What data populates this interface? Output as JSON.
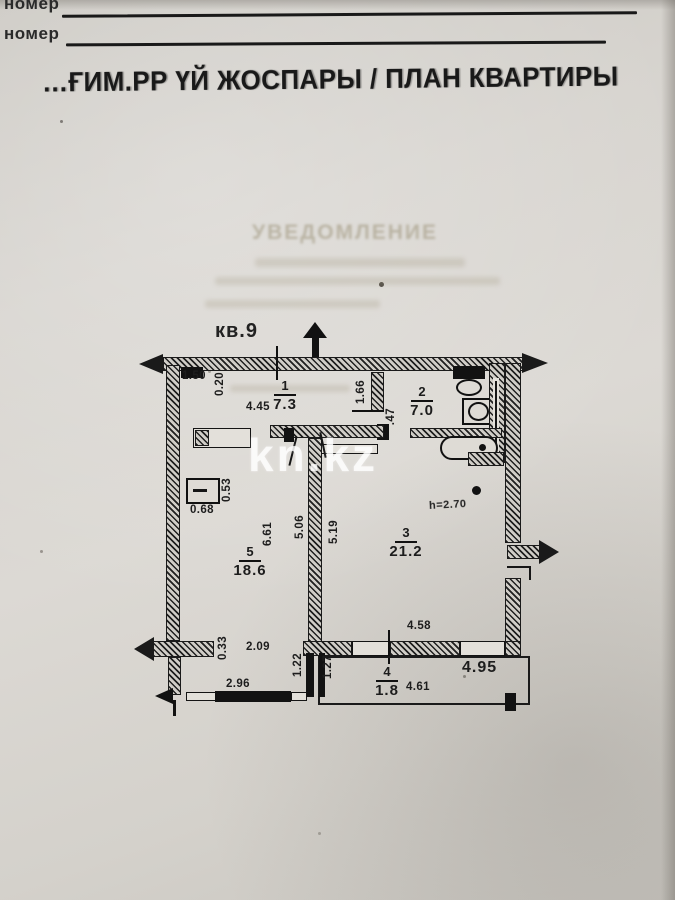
{
  "header": {
    "field_labels": [
      "номер",
      "номер"
    ],
    "title": "…ҒИМ.РР ҮЙ ЖОСПАРЫ / ПЛАН КВАРТИРЫ"
  },
  "ghost_text": "УВЕДОМЛЕНИЕ",
  "watermark": "kn.kz",
  "plan": {
    "apartment_label": "кв.9",
    "height_note": "h=2.70",
    "rooms": [
      {
        "num": "1",
        "area": "7.3"
      },
      {
        "num": "2",
        "area": "7.0"
      },
      {
        "num": "3",
        "area": "21.2"
      },
      {
        "num": "4",
        "area": "1.8"
      },
      {
        "num": "5",
        "area": "18.6"
      }
    ],
    "dims": {
      "entry_niche": "1.50",
      "entry_depth": "0.20",
      "kitchen_width": "4.45",
      "hall_length": "1.66",
      "door_width": ".47",
      "radiator_width": "0.53",
      "radiator_depth": "0.68",
      "room5_length": "6.61",
      "room5_wall": "5.06",
      "room3_wall": "5.19",
      "left_window": "2.09",
      "vent_width": "0.33",
      "bottom_window": "2.96",
      "stub_left": "1.22",
      "stub_right": "1.27",
      "room3_width": "4.58",
      "balcony_length": "4.61",
      "balcony_outer": "4.95"
    }
  }
}
